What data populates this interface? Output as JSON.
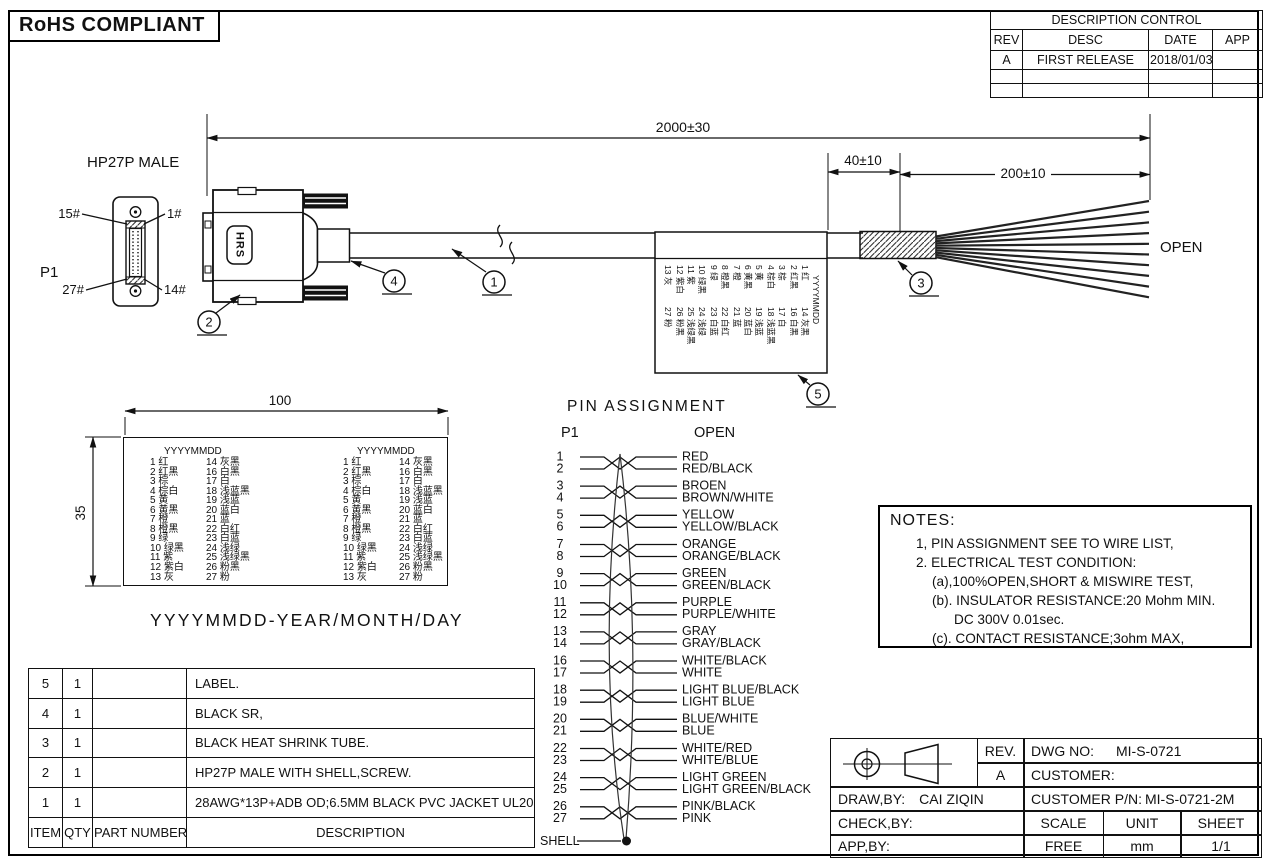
{
  "header": {
    "rohs": "RoHS COMPLIANT",
    "description_control": {
      "title": "DESCRIPTION CONTROL",
      "columns": [
        "REV",
        "DESC",
        "DATE",
        "APP"
      ],
      "rows": [
        [
          "A",
          "FIRST RELEASE",
          "2018/01/03",
          ""
        ],
        [
          "",
          "",
          "",
          ""
        ],
        [
          "",
          "",
          "",
          ""
        ]
      ]
    }
  },
  "drawing": {
    "connector_title": "HP27P MALE",
    "p1_label": "P1",
    "open_label": "OPEN",
    "hrs_logo": "HRS",
    "pin_corner_labels": {
      "top_left": "15#",
      "top_right": "1#",
      "bottom_left": "27#",
      "bottom_right": "14#"
    },
    "dimensions": {
      "overall": "2000±30",
      "sr": "40±10",
      "strip": "200±10"
    },
    "balloons": [
      "1",
      "2",
      "3",
      "4",
      "5"
    ]
  },
  "label_detail": {
    "width_dim": "100",
    "height_dim": "35",
    "header": "YYYYMMDD",
    "rows": [
      [
        "1 红",
        "14 灰黑"
      ],
      [
        "2 红黑",
        "16 白黑"
      ],
      [
        "3 棕",
        "17 白"
      ],
      [
        "4 棕白",
        "18 浅蓝黑"
      ],
      [
        "5 黄",
        "19 浅蓝"
      ],
      [
        "6 黄黑",
        "20 蓝白"
      ],
      [
        "7 橙",
        "21 蓝"
      ],
      [
        "8 橙黑",
        "22 白红"
      ],
      [
        "9 绿",
        "23 白蓝"
      ],
      [
        "10 绿黑",
        "24 浅绿"
      ],
      [
        "11 紫",
        "25 浅绿黑"
      ],
      [
        "12 紫白",
        "26 粉黑"
      ],
      [
        "13 灰",
        "27 粉"
      ]
    ],
    "caption": "YYYYMMDD-YEAR/MONTH/DAY"
  },
  "pin_assignment": {
    "title": "PIN  ASSIGNMENT",
    "left_header": "P1",
    "right_header": "OPEN",
    "pins": [
      {
        "pin": "1",
        "color": "RED"
      },
      {
        "pin": "2",
        "color": "RED/BLACK"
      },
      {
        "pin": "3",
        "color": "BROEN"
      },
      {
        "pin": "4",
        "color": "BROWN/WHITE"
      },
      {
        "pin": "5",
        "color": "YELLOW"
      },
      {
        "pin": "6",
        "color": "YELLOW/BLACK"
      },
      {
        "pin": "7",
        "color": "ORANGE"
      },
      {
        "pin": "8",
        "color": "ORANGE/BLACK"
      },
      {
        "pin": "9",
        "color": "GREEN"
      },
      {
        "pin": "10",
        "color": "GREEN/BLACK"
      },
      {
        "pin": "11",
        "color": "PURPLE"
      },
      {
        "pin": "12",
        "color": "PURPLE/WHITE"
      },
      {
        "pin": "13",
        "color": "GRAY"
      },
      {
        "pin": "14",
        "color": "GRAY/BLACK"
      },
      {
        "pin": "16",
        "color": "WHITE/BLACK"
      },
      {
        "pin": "17",
        "color": "WHITE"
      },
      {
        "pin": "18",
        "color": "LIGHT BLUE/BLACK"
      },
      {
        "pin": "19",
        "color": "LIGHT BLUE"
      },
      {
        "pin": "20",
        "color": "BLUE/WHITE"
      },
      {
        "pin": "21",
        "color": "BLUE"
      },
      {
        "pin": "22",
        "color": "WHITE/RED"
      },
      {
        "pin": "23",
        "color": "WHITE/BLUE"
      },
      {
        "pin": "24",
        "color": "LIGHT GREEN"
      },
      {
        "pin": "25",
        "color": "LIGHT GREEN/BLACK"
      },
      {
        "pin": "26",
        "color": "PINK/BLACK"
      },
      {
        "pin": "27",
        "color": "PINK"
      }
    ],
    "shell_label": "SHELL"
  },
  "notes": {
    "title": "NOTES:",
    "lines": [
      "1, PIN ASSIGNMENT SEE TO WIRE LIST,",
      "2. ELECTRICAL TEST CONDITION:",
      "(a),100%OPEN,SHORT & MISWIRE TEST,",
      "(b). INSULATOR RESISTANCE:20 Mohm MIN.",
      "DC 300V 0.01sec.",
      "(c). CONTACT RESISTANCE;3ohm MAX,"
    ]
  },
  "bom": {
    "columns": [
      "ITEM",
      "QTY",
      "PART NUMBER",
      "DESCRIPTION"
    ],
    "rows": [
      [
        "5",
        "1",
        "",
        "LABEL."
      ],
      [
        "4",
        "1",
        "",
        "BLACK SR,"
      ],
      [
        "3",
        "1",
        "",
        "BLACK HEAT SHRINK TUBE."
      ],
      [
        "2",
        "1",
        "",
        "HP27P MALE WITH SHELL,SCREW."
      ],
      [
        "1",
        "1",
        "",
        "28AWG*13P+ADB OD;6.5MM BLACK PVC JACKET UL20276."
      ]
    ]
  },
  "title_block": {
    "rev_label": "REV.",
    "rev_value": "A",
    "dwg_no_label": "DWG NO:",
    "dwg_no": "MI-S-0721",
    "customer_label": "CUSTOMER:",
    "draw_by_label": "DRAW,BY:",
    "draw_by": "CAI ZIQIN",
    "customer_pn_label": "CUSTOMER P/N:",
    "customer_pn": "MI-S-0721-2M",
    "check_by_label": "CHECK,BY:",
    "app_by_label": "APP,BY:",
    "scale_label": "SCALE",
    "unit_label": "UNIT",
    "sheet_label": "SHEET",
    "scale_value": "FREE",
    "unit_value": "mm",
    "sheet_value": "1/1"
  }
}
